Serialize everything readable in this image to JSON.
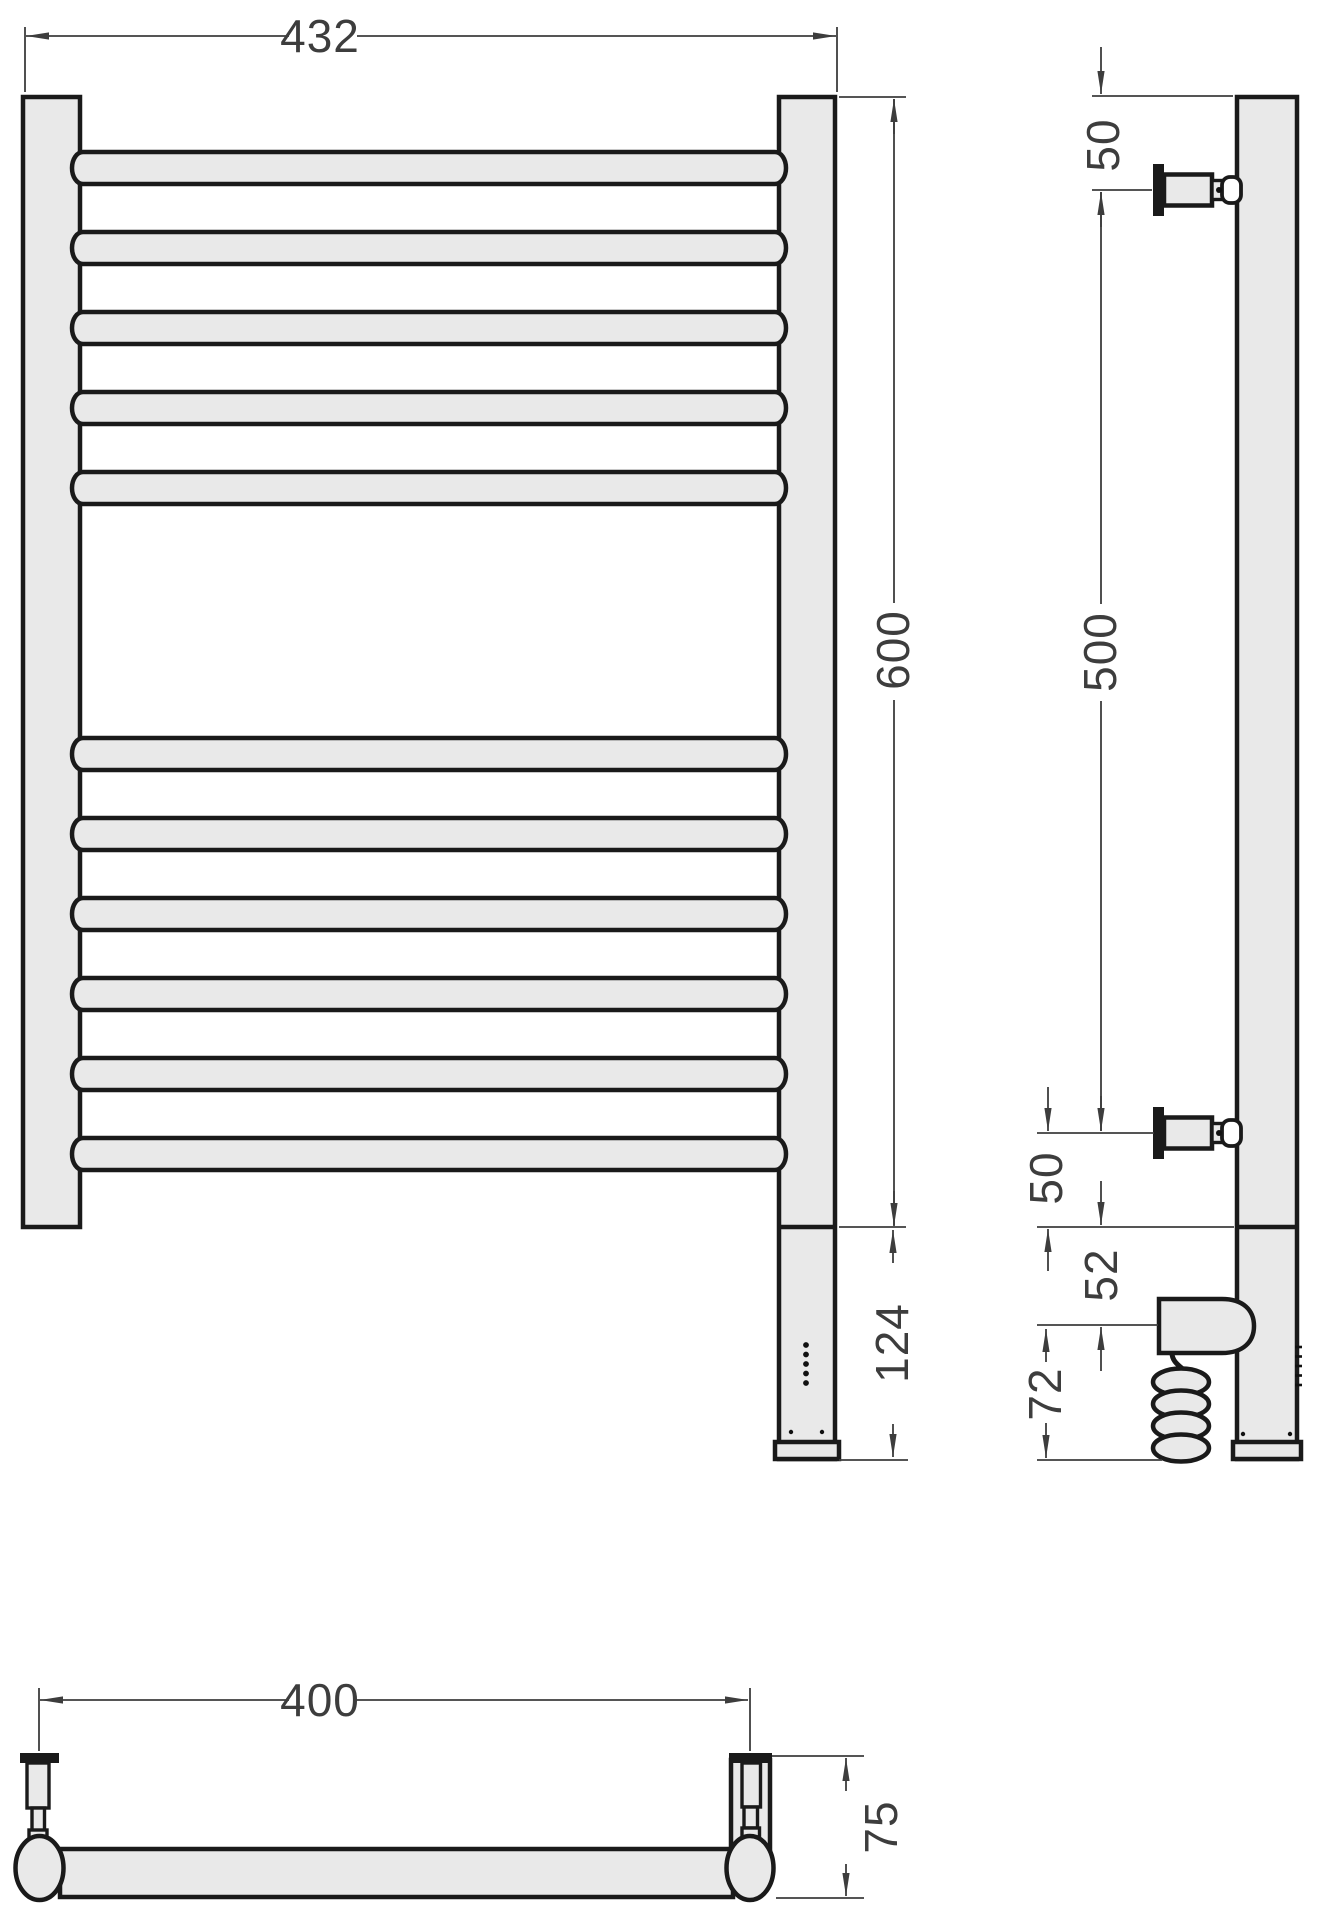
{
  "title": "Electric towel rail dimensioned technical drawing",
  "dims": {
    "front_width": "432",
    "front_height": "600",
    "front_bottom_section": "124",
    "side_top_offset": "50",
    "side_bracket_span": "500",
    "side_bottom_offset": "50",
    "side_heater_offset": "52",
    "side_heater_bottom": "72",
    "plan_mount_distance": "400",
    "plan_depth": "75"
  },
  "colors": {
    "part_fill": "#e9e9e9",
    "outline": "#1a1a1a",
    "dimension_lines": "#3d3d3d",
    "background": "#ffffff"
  }
}
